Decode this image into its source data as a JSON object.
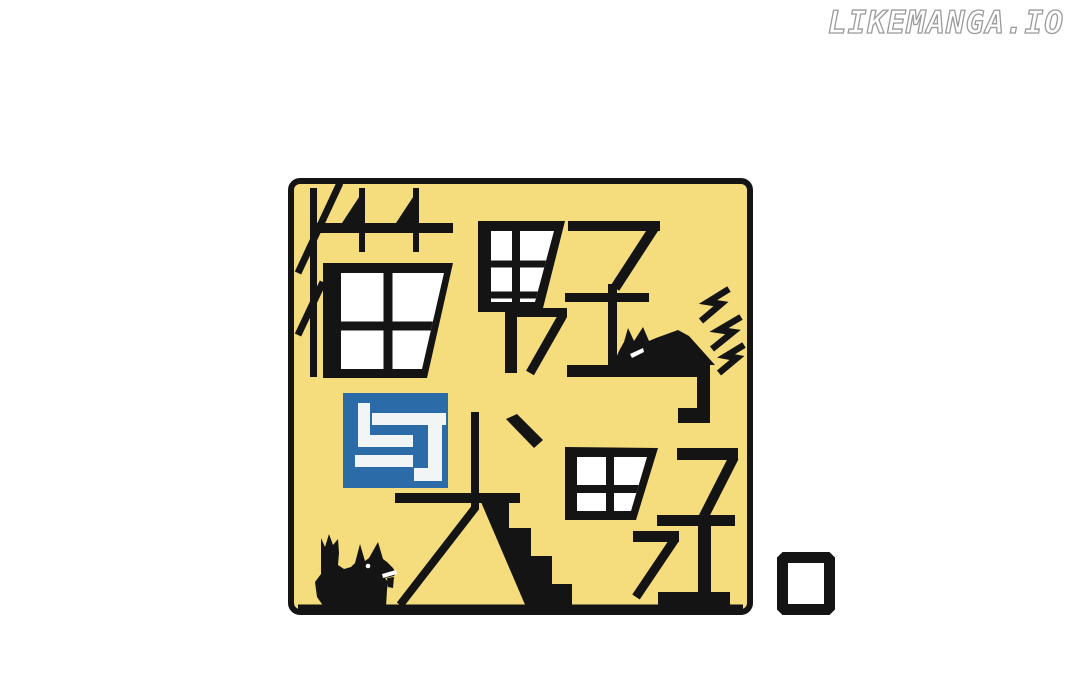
{
  "page": {
    "background_color": "#ffffff"
  },
  "watermark": {
    "text": "LIKEMANGA.IO",
    "fill_color": "#ffffff",
    "outline_color": "#9b9b9b"
  },
  "cover": {
    "full_title": "猫男子与犬男子",
    "title_top_row": "猫男子",
    "title_connector": "与",
    "title_bottom_row": "犬男子",
    "trailing_period": "。",
    "background_color": "#f5dd7d",
    "ink_color": "#141414",
    "connector_box_color": "#2b6ca8",
    "connector_stroke_color": "#f2f5f6",
    "decorations": {
      "cat": "cat-silhouette",
      "lightning_bolt_count": 3,
      "dog": "dog-silhouette",
      "period_mark": "black-outlined-square"
    }
  }
}
